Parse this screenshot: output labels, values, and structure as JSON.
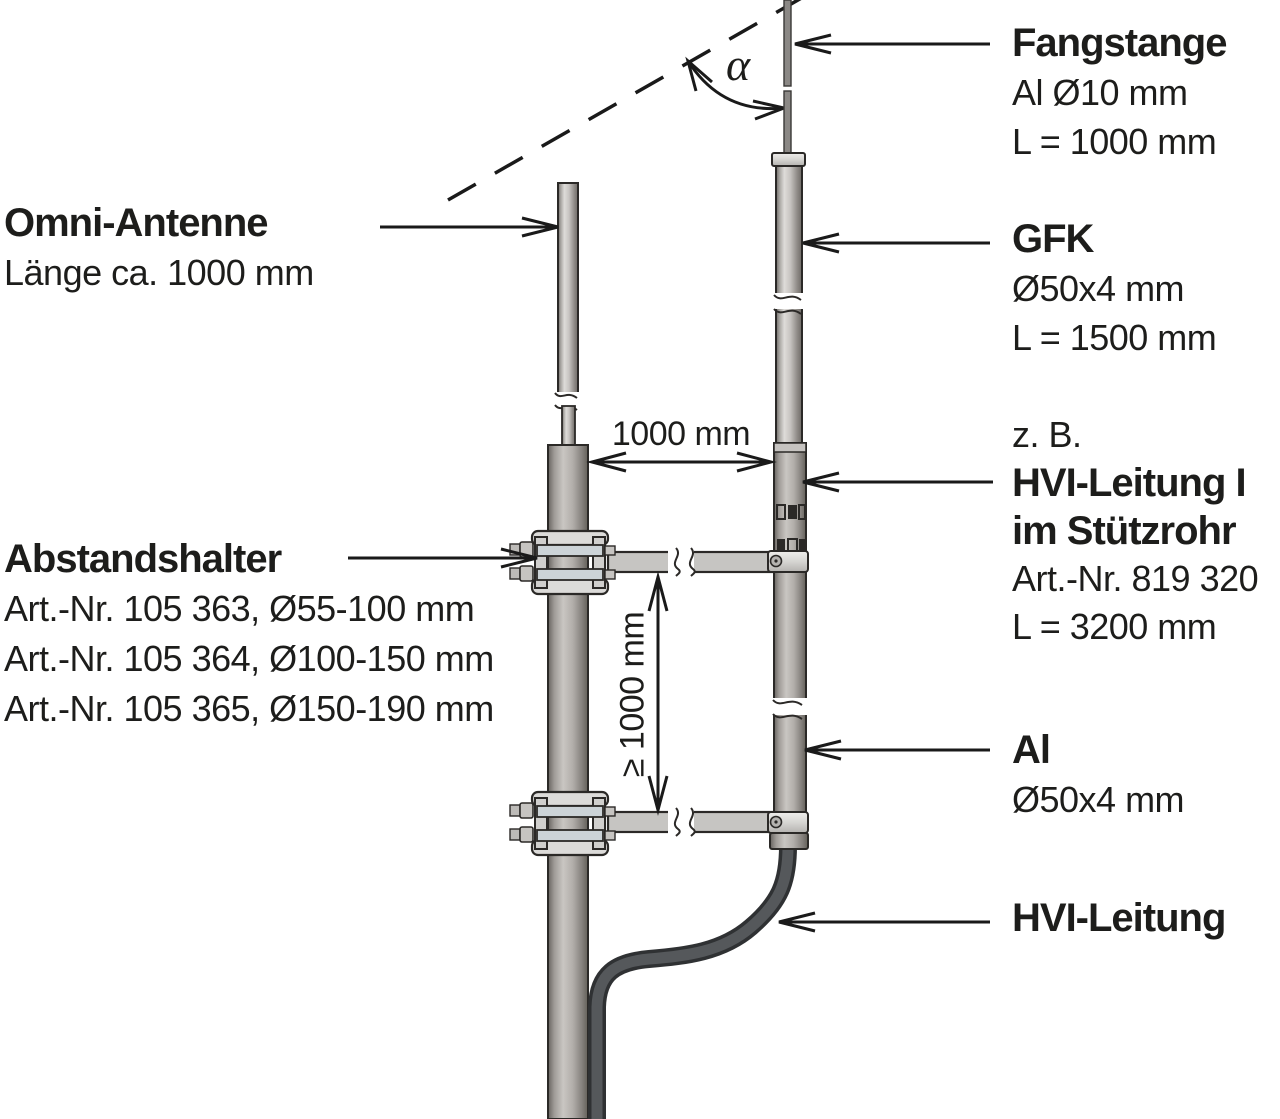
{
  "labels": {
    "fangstange": {
      "title": "Fangstange",
      "spec1": "Al Ø10 mm",
      "spec2": "L = 1000 mm"
    },
    "gfk": {
      "title": "GFK",
      "spec1": "Ø50x4 mm",
      "spec2": "L = 1500 mm"
    },
    "hvi_im_stuetzrohr": {
      "prefix": "z. B.",
      "title_line1": "HVI-Leitung I",
      "title_line2": "im Stützrohr",
      "spec1": "Art.-Nr. 819 320",
      "spec2": "L = 3200 mm"
    },
    "al": {
      "title": "Al",
      "spec1": "Ø50x4 mm"
    },
    "hvi_leitung": {
      "title": "HVI-Leitung"
    },
    "omni_antenne": {
      "title": "Omni-Antenne",
      "spec1": "Länge ca. 1000 mm"
    },
    "abstandshalter": {
      "title": "Abstandshalter",
      "spec1": "Art.-Nr. 105 363, Ø55-100 mm",
      "spec2": "Art.-Nr. 105 364, Ø100-150 mm",
      "spec3": "Art.-Nr. 105 365, Ø150-190 mm"
    }
  },
  "dimensions": {
    "horizontal": "1000 mm",
    "vertical": "≥ 1000 mm",
    "angle": "α"
  },
  "colors": {
    "text": "#1d1d1b",
    "line": "#1a1a1a",
    "outline": "#2b2927",
    "metal_light": "#dedcd9",
    "metal_mid": "#a9a6a2",
    "metal_dark": "#6e6a66",
    "clamp_bar": "#ccd3d7",
    "cable": "#55585b"
  }
}
